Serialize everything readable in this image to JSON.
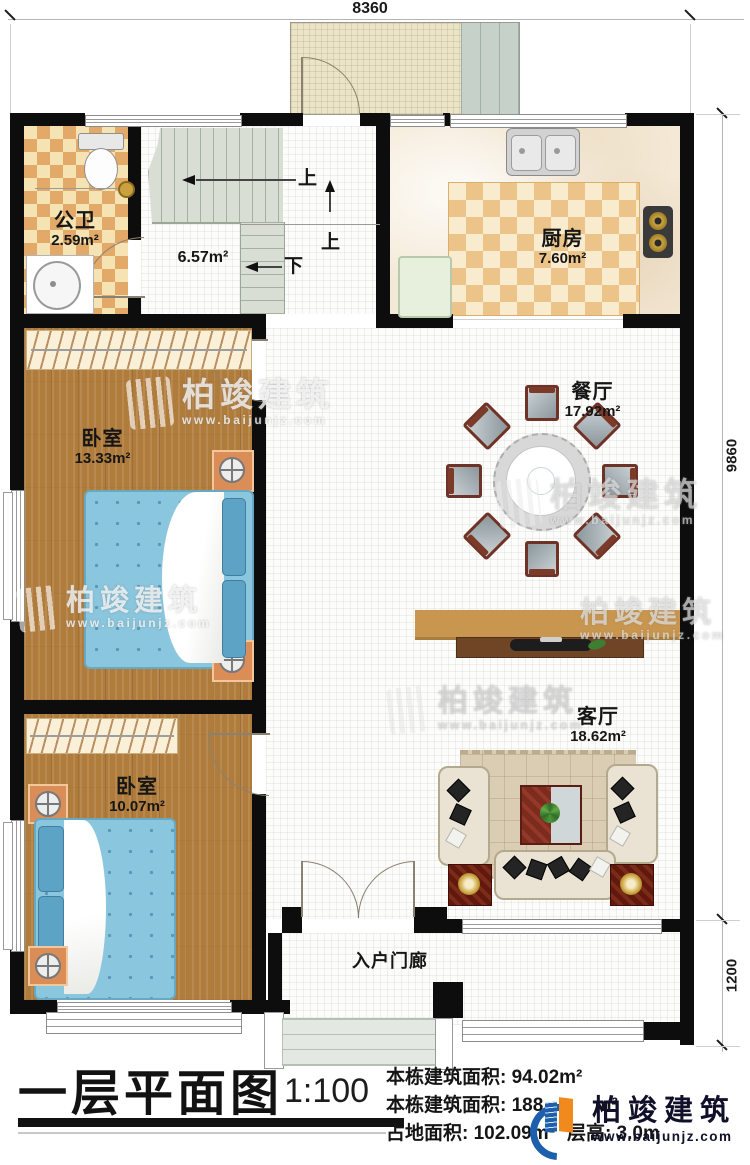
{
  "dimensions": {
    "top": "8360",
    "right_upper": "9860",
    "right_lower": "1200"
  },
  "rooms": {
    "bathroom": {
      "name": "公卫",
      "area": "2.59m²"
    },
    "stair_hall": {
      "area": "6.57m²"
    },
    "kitchen": {
      "name": "厨房",
      "area": "7.60m²"
    },
    "dining": {
      "name": "餐厅",
      "area": "17.92m²"
    },
    "bedroom1": {
      "name": "卧室",
      "area": "13.33m²"
    },
    "bedroom2": {
      "name": "卧室",
      "area": "10.07m²"
    },
    "living": {
      "name": "客厅",
      "area": "18.62m²"
    },
    "porch": {
      "name": "入户门廊"
    }
  },
  "stairs": {
    "up1": "上",
    "up2": "上",
    "down": "下"
  },
  "title_block": {
    "title": "一层平面图",
    "scale": "1:100",
    "line1": "本栋建筑面积: 94.02m²",
    "line2": "本栋建筑面积: 188.",
    "line2_unit": "m²",
    "line3": "占地面积: 102.09m²",
    "line4": "层高: 3.0m"
  },
  "branding": {
    "name": "柏竣建筑",
    "url": "www.baijunjz.com"
  },
  "watermark": {
    "name": "柏竣建筑",
    "url": "www.baijunjz.com"
  }
}
